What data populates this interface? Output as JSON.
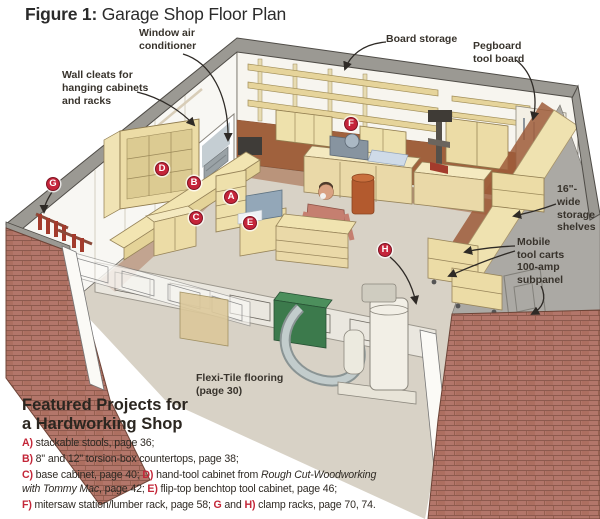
{
  "title": {
    "figure_label": "Figure 1:",
    "text": " Garage Shop Floor Plan"
  },
  "callouts": {
    "window_ac": "Window air\nconditioner",
    "wall_cleats": "Wall cleats for\nhanging cabinets\nand racks",
    "board_storage": "Board storage",
    "pegboard": "Pegboard\ntool board",
    "storage_shelves": "16\"-wide\nstorage\nshelves",
    "mobile_carts": "Mobile\ntool carts",
    "subpanel": "100-amp\nsubpanel",
    "flooring": "Flexi-Tile flooring\n(page 30)"
  },
  "markers": {
    "a": "A",
    "b": "B",
    "c": "C",
    "d": "D",
    "e": "E",
    "f": "F",
    "g": "G",
    "h": "H"
  },
  "legend": {
    "heading": "Featured Projects for\na Hardworking Shop",
    "a_label": "A)",
    "a_text": " stackable stools, page 36;",
    "b_label": "B)",
    "b_text": " 8\" and 12\" torsion-box countertops, page 38;",
    "c_label": "C)",
    "c_text": " base cabinet, page 40; ",
    "d_label": "D)",
    "d_text": " hand-tool cabinet from ",
    "d_italic": "Rough Cut-Woodworking with Tommy Mac",
    "d_text2": ", page 42; ",
    "e_label": "E)",
    "e_text": " flip-top benchtop tool cabinet, page 46;",
    "f_label": "F)",
    "f_text": " mitersaw station/lumber rack, page 58; ",
    "g_label": "G",
    "gh_and": " and ",
    "h_label": "H)",
    "h_text": " clamp racks, page 70, 74."
  },
  "colors": {
    "marker_red": "#c5243a",
    "legend_letter_red": "#c32638",
    "brick": "#b3766a",
    "wood_cream": "#efe2ae",
    "wall_brown": "#a0613d",
    "roof_gray": "#9b9993",
    "floor_tan": "#d8d2c6",
    "label_text": "#38332c"
  }
}
